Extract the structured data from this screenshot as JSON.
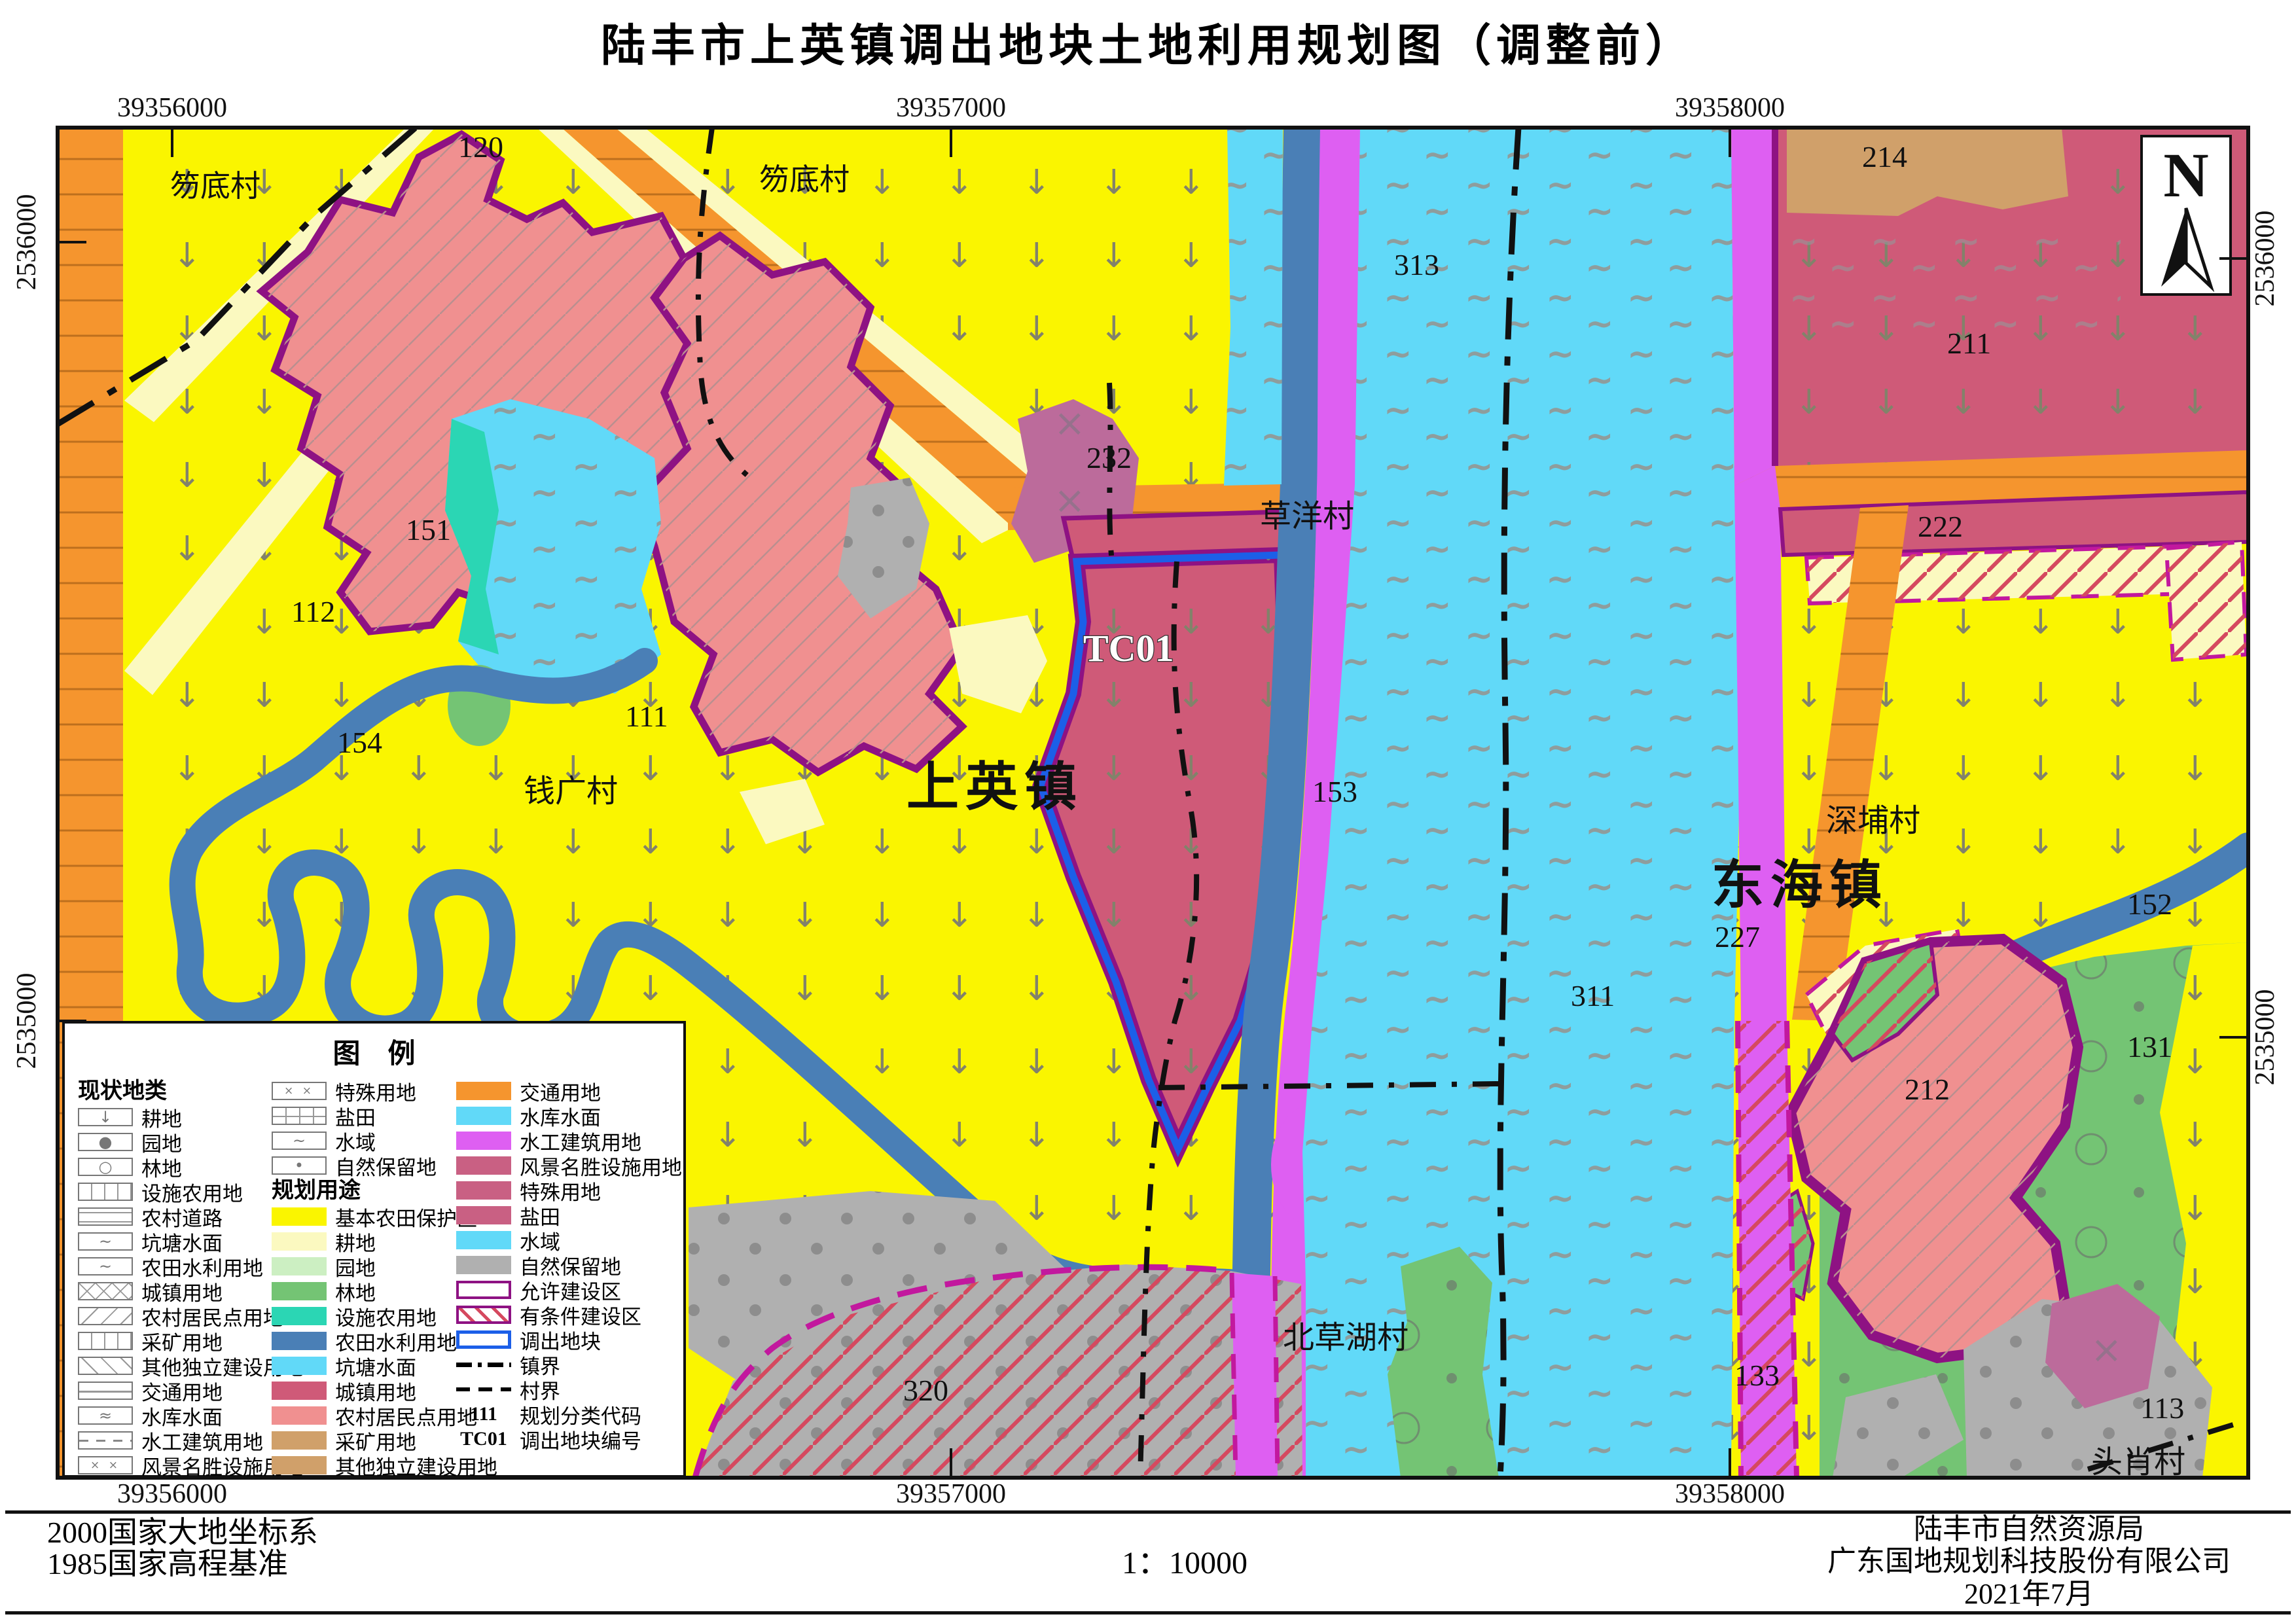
{
  "title": "陆丰市上英镇调出地块土地利用规划图（调整前）",
  "compass": {
    "label": "N"
  },
  "grid": {
    "x": [
      "39356000",
      "39357000",
      "39358000"
    ],
    "y": [
      "2536000",
      "2535000"
    ]
  },
  "map": {
    "labels": {
      "hudicun1": "笏底村",
      "hudicun2": "笏底村",
      "code120": "120",
      "code232": "232",
      "caoyangcun": "草洋村",
      "code313": "313",
      "code214": "214",
      "code211": "211",
      "code222": "222",
      "tc01": "TC01",
      "code151": "151",
      "code112": "112",
      "code154": "154",
      "code111": "111",
      "qianguangcun": "钱广村",
      "shangyingzhen": "上英镇",
      "code153": "153",
      "donghaizhen": "东海镇",
      "shenbucun": "深埔村",
      "code227": "227",
      "code152": "152",
      "code311": "311",
      "code212": "212",
      "code131": "131",
      "beicaohucun": "北草湖村",
      "code320": "320",
      "code133": "133",
      "code113": "113",
      "touxiaocun": "头肖村"
    }
  },
  "legend": {
    "title": "图　例",
    "current_header": "现状地类",
    "planned_header": "规划用途",
    "current": [
      {
        "label": "耕地"
      },
      {
        "label": "园地"
      },
      {
        "label": "林地"
      },
      {
        "label": "设施农用地"
      },
      {
        "label": "农村道路"
      },
      {
        "label": "坑塘水面"
      },
      {
        "label": "农田水利用地"
      },
      {
        "label": "城镇用地"
      },
      {
        "label": "农村居民点用地"
      },
      {
        "label": "采矿用地"
      },
      {
        "label": "其他独立建设用地"
      },
      {
        "label": "交通用地"
      },
      {
        "label": "水库水面"
      },
      {
        "label": "水工建筑用地"
      },
      {
        "label": "风景名胜设施用地"
      }
    ],
    "current2": [
      {
        "label": "特殊用地"
      },
      {
        "label": "盐田"
      },
      {
        "label": "水域"
      },
      {
        "label": "自然保留地"
      }
    ],
    "planned": [
      {
        "label": "基本农田保护区",
        "color": "#FAF500"
      },
      {
        "label": "耕地",
        "color": "#FBF9C0"
      },
      {
        "label": "园地",
        "color": "#CCEFC2"
      },
      {
        "label": "林地",
        "color": "#74C474"
      },
      {
        "label": "设施农用地",
        "color": "#2BD6B4"
      },
      {
        "label": "农田水利用地",
        "color": "#4A7FB6"
      },
      {
        "label": "坑塘水面",
        "color": "#61D9F8"
      },
      {
        "label": "城镇用地",
        "color": "#CF5A78"
      },
      {
        "label": "农村居民点用地",
        "color": "#F09090"
      },
      {
        "label": "采矿用地",
        "color": "#D0A06A"
      },
      {
        "label": "其他独立建设用地",
        "color": "#D0A06A"
      }
    ],
    "planned2": [
      {
        "label": "交通用地",
        "color": "#F5952E"
      },
      {
        "label": "水库水面",
        "color": "#61D9F8"
      },
      {
        "label": "水工建筑用地",
        "color": "#DE5FF2"
      },
      {
        "label": "风景名胜设施用地",
        "color": "#C96083"
      },
      {
        "label": "特殊用地",
        "color": "#C96083"
      },
      {
        "label": "盐田",
        "color": "#C96083"
      },
      {
        "label": "水域",
        "color": "#61D9F8"
      },
      {
        "label": "自然保留地",
        "color": "#B0B0B0"
      }
    ],
    "zones": [
      {
        "label": "允许建设区"
      },
      {
        "label": "有条件建设区"
      },
      {
        "label": "调出地块"
      }
    ],
    "boundaries": [
      {
        "label": "镇界"
      },
      {
        "label": "村界"
      }
    ],
    "codes": [
      {
        "code": "111",
        "label": "规划分类代码"
      },
      {
        "code": "TC01",
        "label": "调出地块编号"
      }
    ]
  },
  "footer": {
    "datum_line1": "2000国家大地坐标系",
    "datum_line2": "1985国家高程基准",
    "scale": "1：10000",
    "org_line1": "陆丰市自然资源局",
    "org_line2": "广东国地规划科技股份有限公司",
    "org_line3": "2021年7月"
  },
  "colors": {
    "basic_farmland_yellow": "#FAF500",
    "planned_arable_cream": "#FBF9C0",
    "orchard_green": "#CCEFC2",
    "forest_green": "#74C474",
    "facility_teal": "#2BD6B4",
    "irrigation_blue": "#4A7FB6",
    "pond_cyan": "#61D9F8",
    "town_rose": "#CF5A78",
    "village_salmon": "#F09090",
    "mining_tan": "#D0A06A",
    "traffic_orange": "#F5952E",
    "hydraulic_magenta": "#DE5FF2",
    "special_mauve": "#BC6B9B",
    "nature_gray": "#B0B0B0",
    "allow_zone_border": "#8E1283",
    "outparcel_border": "#1C5FE8",
    "conditional_border": "#C2189E"
  }
}
